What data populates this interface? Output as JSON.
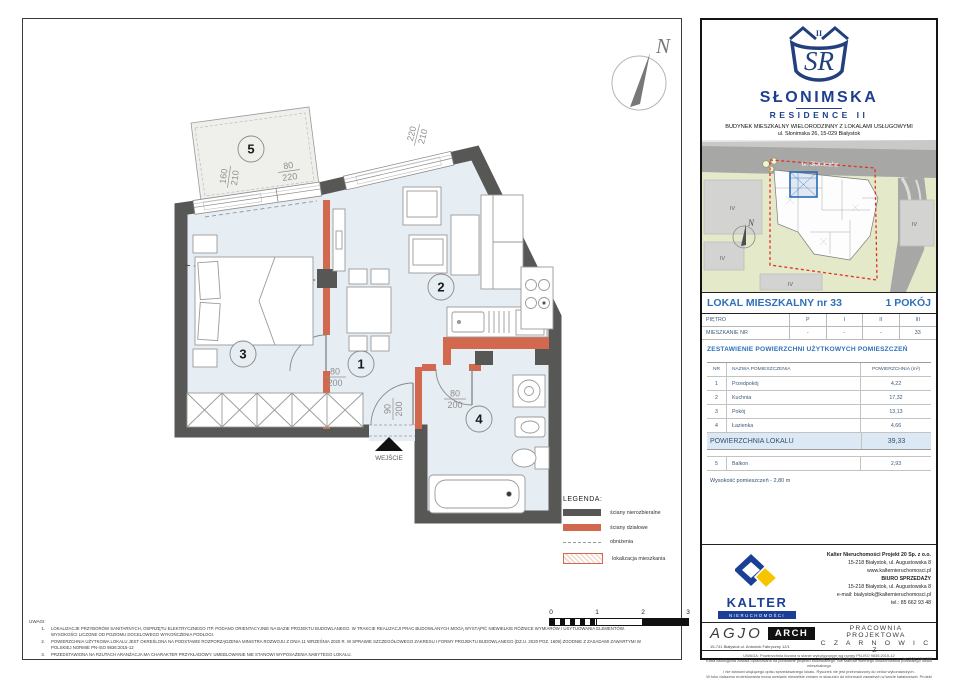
{
  "header": {
    "monogram": "SR",
    "roman": "II",
    "title": "SŁONIMSKA",
    "subtitle": "RESIDENCE II",
    "line1": "BUDYNEK MIESZKALNY WIELORODZINNY Z LOKALAMI USŁUGOWYMI",
    "line2": "ul. Słonimska 26, 15-029 Białystok"
  },
  "map": {
    "street": "ul. Słonimska",
    "north": "N",
    "zones": [
      "IV",
      "IV",
      "IV",
      "IV"
    ]
  },
  "unit": {
    "title": "LOKAL MIESZKALNY  nr 33",
    "rooms": "1 POKÓJ",
    "floors": {
      "label1": "PIĘTRO",
      "values1": [
        "P",
        "I",
        "II",
        "III"
      ],
      "label2": "MIESZKANIE NR",
      "values2": [
        "-",
        "-",
        "-",
        "33"
      ]
    },
    "areas_title": "ZESTAWIENIE POWIERZCHNI UŻYTKOWYCH POMIESZCZEŃ",
    "table": {
      "h_nr": "NR",
      "h_name": "NAZWA POMIESZCZENIA",
      "h_area": "POWIERZCHNIA (m²)",
      "rows": [
        {
          "nr": "1",
          "name": "Przedpokój",
          "area": "4,22"
        },
        {
          "nr": "2",
          "name": "Kuchnia",
          "area": "17,32"
        },
        {
          "nr": "3",
          "name": "Pokój",
          "area": "13,13"
        },
        {
          "nr": "4",
          "name": "Łazienka",
          "area": "4,66"
        }
      ],
      "total_label": "POWIERZCHNIA LOKALU",
      "total": "39,33",
      "balcony": {
        "nr": "5",
        "name": "Balkon",
        "area": "2,93"
      },
      "height_note": "Wysokość pomieszczeń - 2,80 m"
    }
  },
  "plan": {
    "north": "N",
    "entrance": "WEJŚCIE",
    "room_numbers": [
      "1",
      "2",
      "3",
      "4",
      "5"
    ],
    "dims": {
      "d1w": "160",
      "d1h": "210",
      "d2w": "80",
      "d2h": "220",
      "d3w": "220",
      "d3h": "210",
      "d4w": "80",
      "d4h": "200",
      "d5w": "90",
      "d5h": "200",
      "d6w": "80",
      "d6h": "200"
    }
  },
  "legend": {
    "title": "LEGENDA:",
    "items": [
      "ściany nierozbieralne",
      "ściany działowe",
      "obniżenia",
      "lokalizacja mieszkania"
    ],
    "scale": [
      "0",
      "1",
      "2",
      "3"
    ]
  },
  "notes": {
    "title": "UWAGI:",
    "n1": "1.",
    "t1": "LOKALIZACJE PRZYBORÓW SANITARNYCH, OSPRZĘTU ELEKTRYCZNEGO ITP. PODANO ORIENTACYJNIE NA BAZIE PROJEKTU BUDOWLANEGO. W TRAKCIE REALIZACJI PRAC BUDOWLANYCH MOGĄ WYSTĄPIĆ NIEWIELKIE RÓŻNICE WYMIARÓW I USYTUOWANIA ELEMENTÓW. WYSOKOŚCI LICZONE OD POZIOMU DOCELOWEGO WYKOŃCZENIA PODŁOGI.",
    "n2": "2.",
    "t2": "POWIERZCHNIA UŻYTKOWA LOKALU JEST OKREŚLONA NA PODSTAWIE ROZPORZĄDZENIA MINISTRA ROZWOJU Z DNIA 11 WRZEŚNIA 2020 R. W SPRAWIE SZCZEGÓŁOWEGO ZAKRESU I FORMY PROJEKTU BUDOWLANEGO (DZ.U. 2020 POZ. 1609) ZGODNIE Z ZASADAMI ZAWARTYMI W POLSKIEJ NORMIE PN-ISO 9836:2015-12",
    "n3": "3.",
    "t3": "PRZEDSTAWIONA NA RZUTACH ARANŻACJA MA CHARAKTER PRZYKŁADOWY. UMEBLOWANIE NIE STANOWI WYPOSAŻENIA NABYTEGO LOKALU."
  },
  "kalter": {
    "name": "KALTER",
    "sub": "NIERUCHOMOŚCI",
    "l1": "Kalter Nieruchomości Projekt 20  Sp. z o.o.",
    "l2": "15-218 Białystok, ul. Augustowska 8",
    "l3": "www.kalternieruchomosci.pl",
    "l4": "BIURO SPRZEDAŻY",
    "l5": "15-218 Białystok, ul. Augustowska 8",
    "l6": "e-mail: bialystok@kalternieruchomosci.pl",
    "l7": "tel.: 85 662 93 48"
  },
  "studio": {
    "agjo": "AGJO",
    "arch": "ARCH",
    "address": "15-741 Białystok    ul. Antoniuk Fabryczny  12/1",
    "p1": "PRACOWNIA PROJEKTOWA",
    "p2": "C Z A R N O W I C Z",
    "nip": "NIP:  542 186 35 28",
    "tel": "tel. 501-154-380"
  },
  "disclaimer": {
    "l1": "UWAGA:  Powierzchnia liczona w stanie wykończonym wg normy PN-ISO 9836:2015-12",
    "l2": "Karta katalogowa została opracowana na podstawie projektu budowlanego. Nie stanowi wiernego odwzorowania powstałego lokalu mieszkalnego",
    "l3": "i nie stanowi wiążącego opisu sprzedawanego lokalu. Rysunek nie jest przeznaczony do celów wykonawczych.",
    "l4": "W toku dalszego projektowania mogą wystąpić niewielkie zmiany w stosunku do informacji zawartych w karcie katalogowej. Projekt chroniony prawem autorskim."
  },
  "colors": {
    "accent_blue": "#2e71b8",
    "navy": "#1e3f8f",
    "wall_gray": "#575756",
    "partition_orange": "#d2694e",
    "floor_blue": "#e6edf3",
    "highlight_row": "#dce9f5",
    "map_green": "#e4e9c9",
    "boundary_red": "#e03222",
    "kalter_yellow": "#f6c500"
  }
}
